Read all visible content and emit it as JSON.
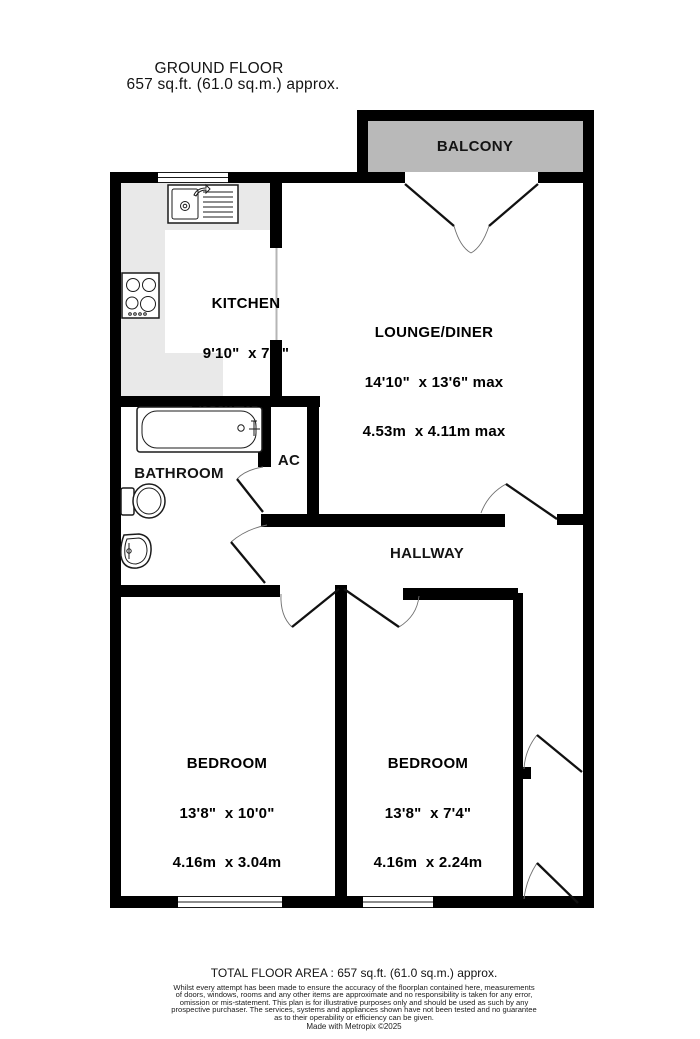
{
  "title": {
    "line1": "GROUND FLOOR",
    "line2": "657 sq.ft. (61.0 sq.m.) approx."
  },
  "rooms": {
    "balcony": {
      "label": "BALCONY"
    },
    "kitchen": {
      "label": "KITCHEN",
      "size_imperial": "9'10\"  x 7'3\"",
      "size_metric": "2.99m  x 2.22m"
    },
    "lounge": {
      "label": "LOUNGE/DINER",
      "size_imperial": "14'10\"  x 13'6\" max",
      "size_metric": "4.53m  x 4.11m max"
    },
    "bathroom": {
      "label": "BATHROOM"
    },
    "ac": {
      "label": "AC"
    },
    "hallway": {
      "label": "HALLWAY"
    },
    "bedroom1": {
      "label": "BEDROOM",
      "size_imperial": "13'8\"  x 10'0\"",
      "size_metric": "4.16m  x 3.04m"
    },
    "bedroom2": {
      "label": "BEDROOM",
      "size_imperial": "13'8\"  x 7'4\"",
      "size_metric": "4.16m  x 2.24m"
    }
  },
  "footer": {
    "total_area": "TOTAL FLOOR AREA : 657 sq.ft. (61.0 sq.m.) approx.",
    "disclaimer": "Whilst every attempt has been made to ensure the accuracy of the floorplan contained here, measurements\nof doors, windows, rooms and any other items are approximate and no responsibility is taken for any error,\nomission or mis-statement. This plan is for illustrative purposes only and should be used as such by any\nprospective purchaser. The services, systems and appliances shown have not been tested and no guarantee\nas to their operability or efficiency can be given.",
    "credit": "Made with Metropix ©2025"
  },
  "colors": {
    "wall": "#000000",
    "balcony_fill": "#b9b9b9",
    "counter_fill": "#e9e9e9",
    "door_arc": "#6f6f6f"
  }
}
